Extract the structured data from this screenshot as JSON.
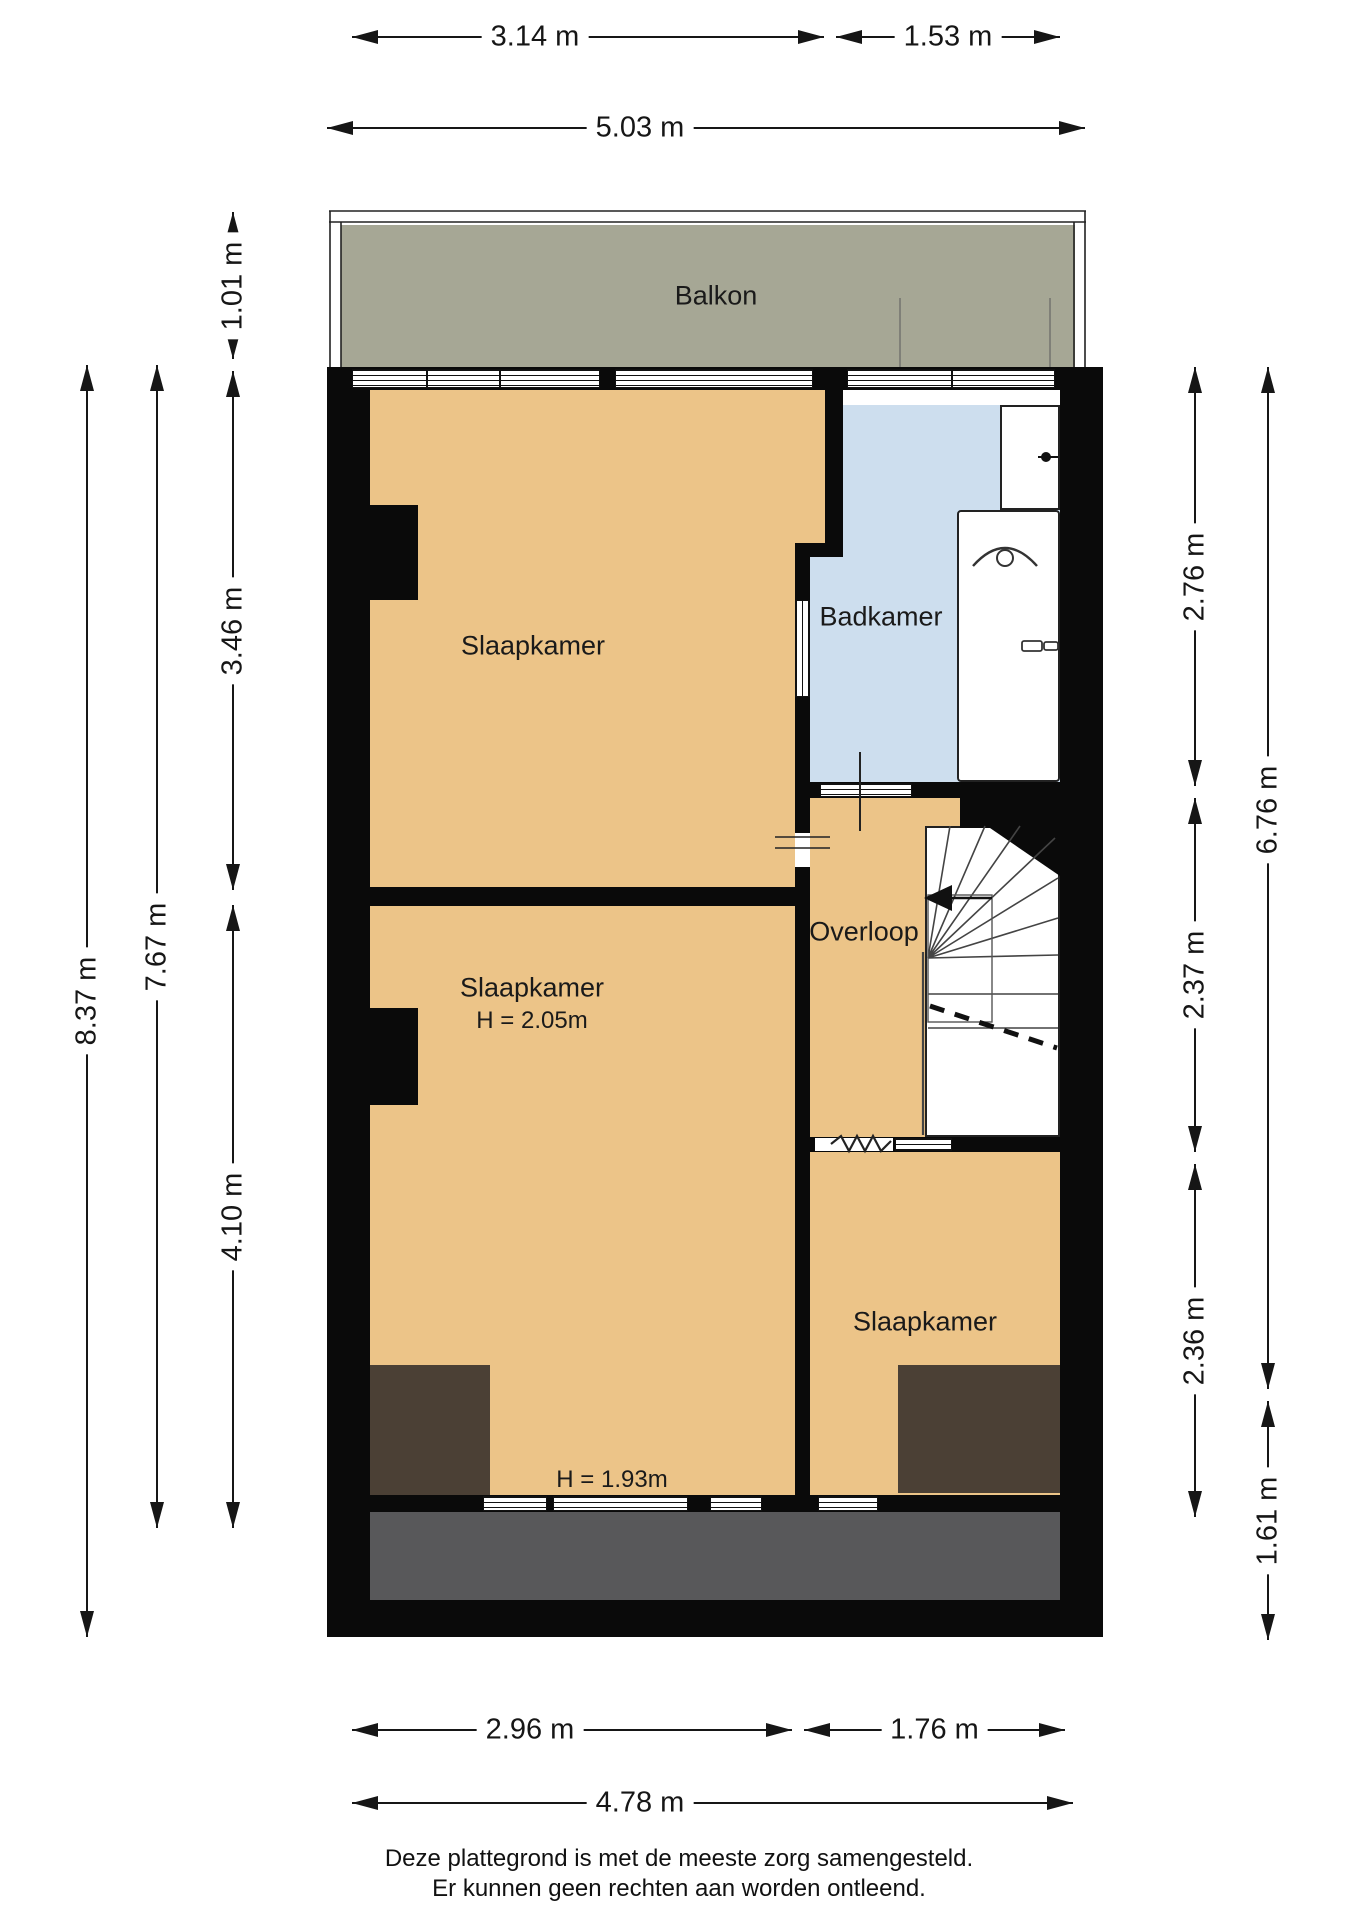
{
  "title": "Plattegrond verdieping",
  "colors": {
    "wall": "#0a0a0a",
    "floor": "#ecc488",
    "bathroom": "#cddeee",
    "balcony": "#a6a795",
    "low_ceiling": "#4b4035",
    "roof": "#58585a",
    "dim": "#161616"
  },
  "labels": [
    {
      "id": "balkon-label",
      "text": "Balkon",
      "cx": 716,
      "cy": 296,
      "size": 27
    },
    {
      "id": "slaapkamer-1-label",
      "text": "Slaapkamer",
      "cx": 533,
      "cy": 646,
      "size": 27
    },
    {
      "id": "badkamer-label",
      "text": "Badkamer",
      "cx": 881,
      "cy": 617,
      "size": 27
    },
    {
      "id": "overloop-label",
      "text": "Overloop",
      "cx": 864,
      "cy": 932,
      "size": 27
    },
    {
      "id": "slaapkamer-2-label",
      "text": "Slaapkamer",
      "cx": 532,
      "cy": 988,
      "size": 27
    },
    {
      "id": "slaapkamer-2-height",
      "text": "H = 2.05m",
      "cx": 532,
      "cy": 1021,
      "size": 24
    },
    {
      "id": "slaapkamer-3-label",
      "text": "Slaapkamer",
      "cx": 925,
      "cy": 1322,
      "size": 27
    },
    {
      "id": "height-note",
      "text": "H = 1.93m",
      "cx": 612,
      "cy": 1480,
      "size": 24
    }
  ],
  "dimensions": [
    {
      "id": "dim-top-1",
      "label": "3.14 m",
      "dir": "h",
      "x1": 352,
      "x2": 824,
      "y": 37,
      "lx": 535
    },
    {
      "id": "dim-top-2",
      "label": "1.53 m",
      "dir": "h",
      "x1": 836,
      "x2": 1060,
      "y": 37
    },
    {
      "id": "dim-top-3",
      "label": "5.03 m",
      "dir": "h",
      "x1": 327,
      "x2": 1085,
      "y": 128,
      "lx": 640
    },
    {
      "id": "dim-left-1",
      "label": "1.01 m",
      "dir": "v",
      "y1": 212,
      "y2": 359,
      "x": 233
    },
    {
      "id": "dim-left-2",
      "label": "3.46 m",
      "dir": "v",
      "y1": 371,
      "y2": 890,
      "x": 233
    },
    {
      "id": "dim-left-3",
      "label": "4.10 m",
      "dir": "v",
      "y1": 905,
      "y2": 1528,
      "x": 233
    },
    {
      "id": "dim-left-4",
      "label": "7.67 m",
      "dir": "v",
      "y1": 365,
      "y2": 1528,
      "x": 157
    },
    {
      "id": "dim-left-5",
      "label": "8.37 m",
      "dir": "v",
      "y1": 365,
      "y2": 1637,
      "x": 87
    },
    {
      "id": "dim-right-1",
      "label": "2.76 m",
      "dir": "v",
      "y1": 367,
      "y2": 786,
      "x": 1195
    },
    {
      "id": "dim-right-2",
      "label": "2.37 m",
      "dir": "v",
      "y1": 798,
      "y2": 1152,
      "x": 1195
    },
    {
      "id": "dim-right-3",
      "label": "2.36 m",
      "dir": "v",
      "y1": 1164,
      "y2": 1517,
      "x": 1195
    },
    {
      "id": "dim-right-4",
      "label": "6.76 m",
      "dir": "v",
      "y1": 367,
      "y2": 1389,
      "x": 1268,
      "ly": 810
    },
    {
      "id": "dim-right-5",
      "label": "1.61 m",
      "dir": "v",
      "y1": 1401,
      "y2": 1640,
      "x": 1268
    },
    {
      "id": "dim-bottom-1",
      "label": "2.96 m",
      "dir": "h",
      "x1": 352,
      "x2": 792,
      "y": 1730,
      "lx": 530
    },
    {
      "id": "dim-bottom-2",
      "label": "1.76 m",
      "dir": "h",
      "x1": 804,
      "x2": 1065,
      "y": 1730
    },
    {
      "id": "dim-bottom-3",
      "label": "4.78 m",
      "dir": "h",
      "x1": 352,
      "x2": 1073,
      "y": 1803,
      "lx": 640
    }
  ],
  "windows": [
    {
      "x": 352,
      "y": 369,
      "w": 75,
      "h": 19,
      "o": "h",
      "kind": "window"
    },
    {
      "x": 427,
      "y": 369,
      "w": 73,
      "h": 19,
      "o": "h",
      "kind": "window"
    },
    {
      "x": 500,
      "y": 369,
      "w": 100,
      "h": 19,
      "o": "h",
      "kind": "window"
    },
    {
      "x": 615,
      "y": 369,
      "w": 198,
      "h": 19,
      "o": "h",
      "kind": "window"
    },
    {
      "x": 847,
      "y": 369,
      "w": 105,
      "h": 19,
      "o": "h",
      "kind": "window"
    },
    {
      "x": 952,
      "y": 369,
      "w": 103,
      "h": 19,
      "o": "h",
      "kind": "window"
    },
    {
      "x": 483,
      "y": 1496,
      "w": 64,
      "h": 15,
      "o": "h",
      "kind": "window"
    },
    {
      "x": 553,
      "y": 1496,
      "w": 135,
      "h": 15,
      "o": "h",
      "kind": "window"
    },
    {
      "x": 710,
      "y": 1496,
      "w": 52,
      "h": 15,
      "o": "h",
      "kind": "window"
    },
    {
      "x": 818,
      "y": 1496,
      "w": 60,
      "h": 15,
      "o": "h",
      "kind": "window"
    },
    {
      "x": 820,
      "y": 783,
      "w": 92,
      "h": 14,
      "o": "h",
      "kind": "door-threshold"
    },
    {
      "x": 895,
      "y": 1138,
      "w": 57,
      "h": 13,
      "o": "h",
      "kind": "door-threshold"
    },
    {
      "x": 795,
      "y": 600,
      "w": 15,
      "h": 97,
      "o": "v",
      "kind": "interior-window"
    }
  ],
  "gaps": [
    {
      "x": 795,
      "y": 833,
      "w": 15,
      "h": 34
    },
    {
      "x": 815,
      "y": 1138,
      "w": 16,
      "h": 13
    },
    {
      "x": 831,
      "y": 1138,
      "w": 62,
      "h": 13
    }
  ],
  "fixtures": {
    "washbasin": "washbasin-icon",
    "bathtub": "bathtub-icon",
    "staircase": "staircase-icon",
    "direction_arrow": "stairs-direction-arrow-icon"
  },
  "footer": {
    "line1": "Deze plattegrond is met de meeste zorg samengesteld.",
    "line2": "Er kunnen geen rechten aan worden ontleend."
  }
}
